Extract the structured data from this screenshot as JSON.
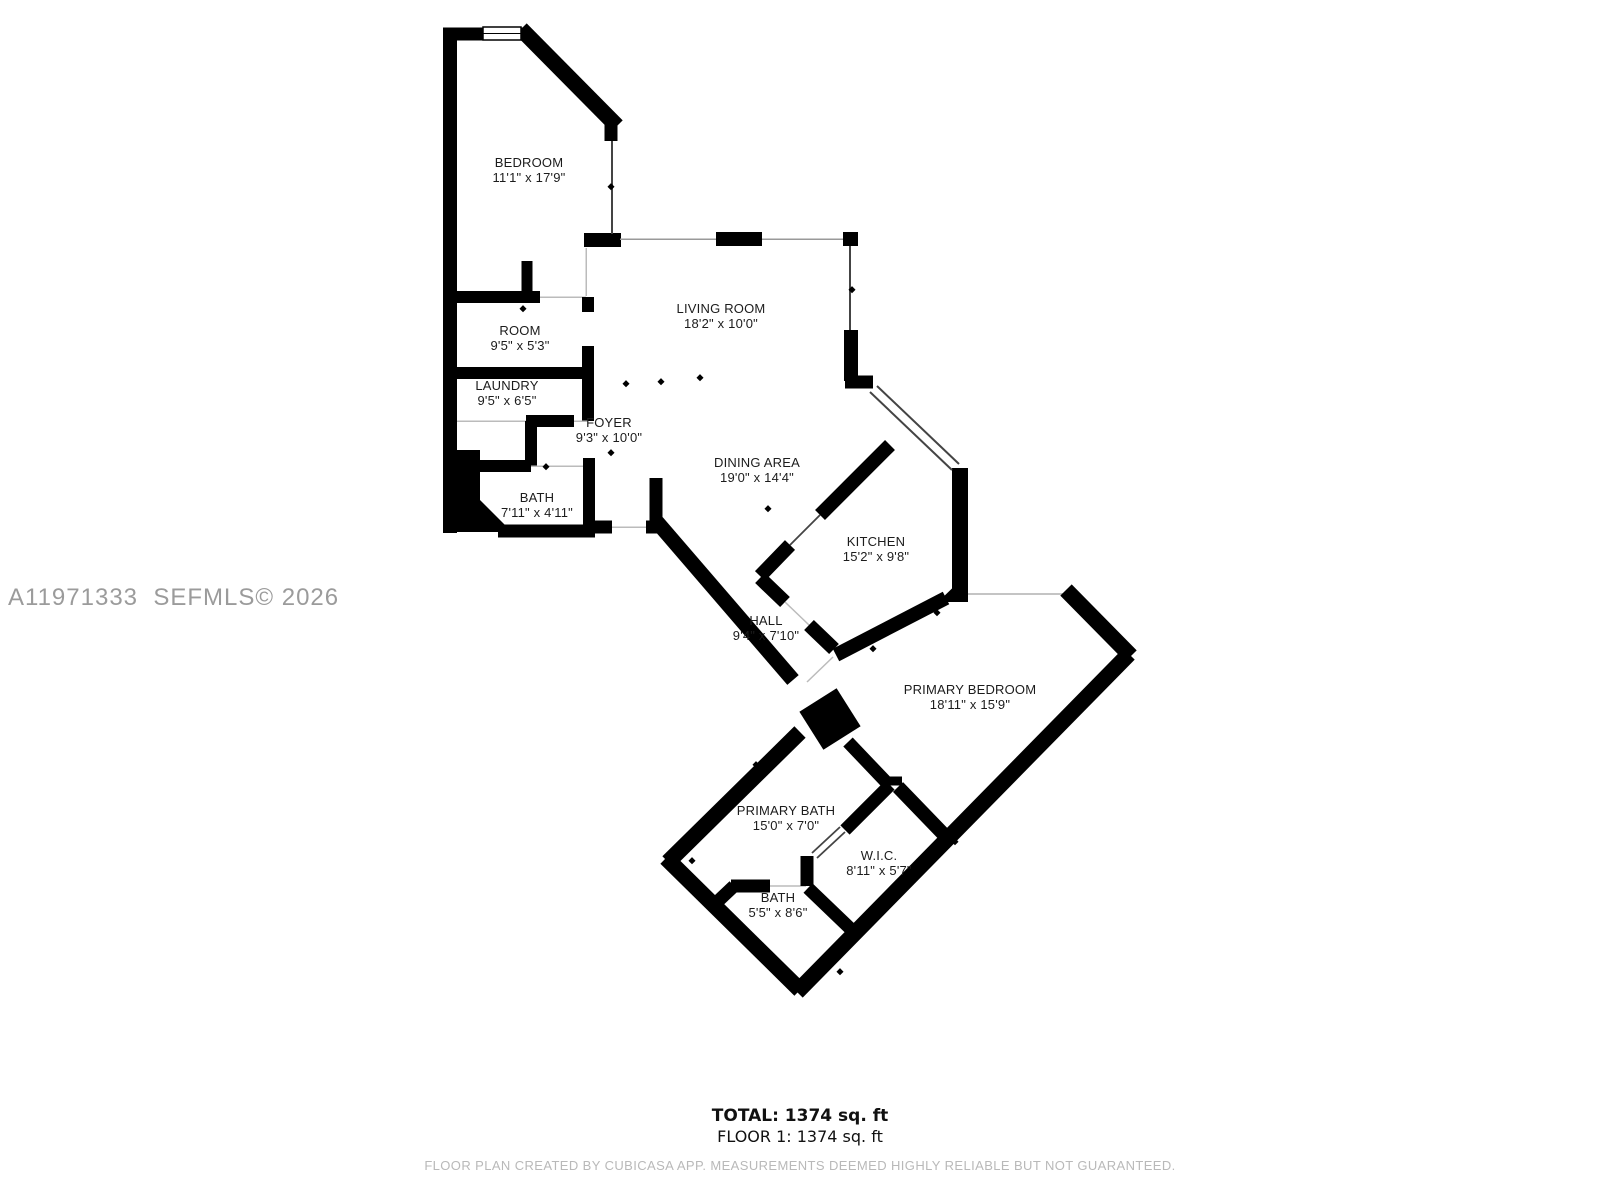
{
  "watermark": "A11971333  SEFMLS© 2026",
  "rooms": [
    {
      "id": "bedroom",
      "name": "BEDROOM",
      "dims": "11'1\" x 17'9\""
    },
    {
      "id": "living-room",
      "name": "LIVING ROOM",
      "dims": "18'2\" x 10'0\""
    },
    {
      "id": "room",
      "name": "ROOM",
      "dims": "9'5\" x 5'3\""
    },
    {
      "id": "laundry",
      "name": "LAUNDRY",
      "dims": "9'5\" x 6'5\""
    },
    {
      "id": "foyer",
      "name": "FOYER",
      "dims": "9'3\" x 10'0\""
    },
    {
      "id": "bath",
      "name": "BATH",
      "dims": "7'11\" x 4'11\""
    },
    {
      "id": "dining-area",
      "name": "DINING AREA",
      "dims": "19'0\" x 14'4\""
    },
    {
      "id": "kitchen",
      "name": "KITCHEN",
      "dims": "15'2\" x 9'8\""
    },
    {
      "id": "hall",
      "name": "HALL",
      "dims": "9'4\" x 7'10\""
    },
    {
      "id": "primary-bedroom",
      "name": "PRIMARY BEDROOM",
      "dims": "18'11\" x 15'9\""
    },
    {
      "id": "primary-bath",
      "name": "PRIMARY BATH",
      "dims": "15'0\" x 7'0\""
    },
    {
      "id": "wic",
      "name": "W.I.C.",
      "dims": "8'11\" x 5'7\""
    },
    {
      "id": "bath-2",
      "name": "BATH",
      "dims": "5'5\" x 8'6\""
    }
  ],
  "footer": {
    "total": "TOTAL: 1374 sq. ft",
    "floor": "FLOOR 1: 1374 sq. ft",
    "disclaimer": "FLOOR PLAN CREATED BY CUBICASA APP. MEASUREMENTS DEEMED HIGHLY RELIABLE BUT NOT GUARANTEED."
  },
  "colors": {
    "wall": "#000000",
    "opening_line": "#bbbbbb",
    "window_line": "#444444",
    "label_text": "#1c1c1c",
    "watermark_text": "#9b9b9b",
    "disclaimer_text": "#b9b9b9"
  }
}
